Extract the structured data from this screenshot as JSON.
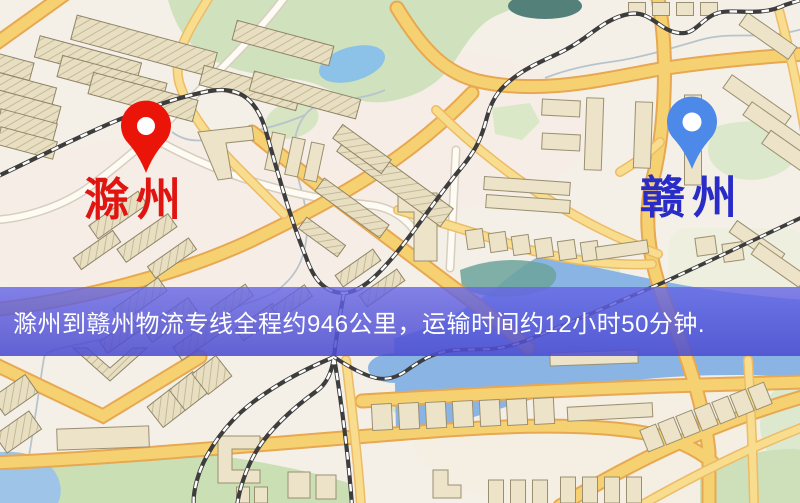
{
  "banner": {
    "text": "滁州到赣州物流专线全程约946公里，运输时间约12小时50分钟.",
    "background_color": "#5456d8",
    "text_color": "#ffffff"
  },
  "markers": {
    "origin": {
      "label": "滁州",
      "pin_color": "#ea1409",
      "label_color": "#e01511"
    },
    "destination": {
      "label": "赣州",
      "pin_color": "#4c89e8",
      "label_color": "#2a2cc8"
    }
  },
  "route": {
    "origin_city": "滁州",
    "destination_city": "赣州",
    "distance_text": "约946公里",
    "duration_text": "约12小时50分钟"
  },
  "map_palette": {
    "background": "#f5f0e7",
    "road_major_fill": "#f6d171",
    "road_major_casing": "#e7a851",
    "road_minor_fill": "#f8dd8e",
    "road_white_fill": "#fdfbf4",
    "water": "#8fbfe8",
    "water_dark": "#54807a",
    "park_green": "#cfe2bd",
    "building_fill": "#ece3c8",
    "building_outline": "#9a8f70",
    "railway": "#3d3d3d"
  }
}
